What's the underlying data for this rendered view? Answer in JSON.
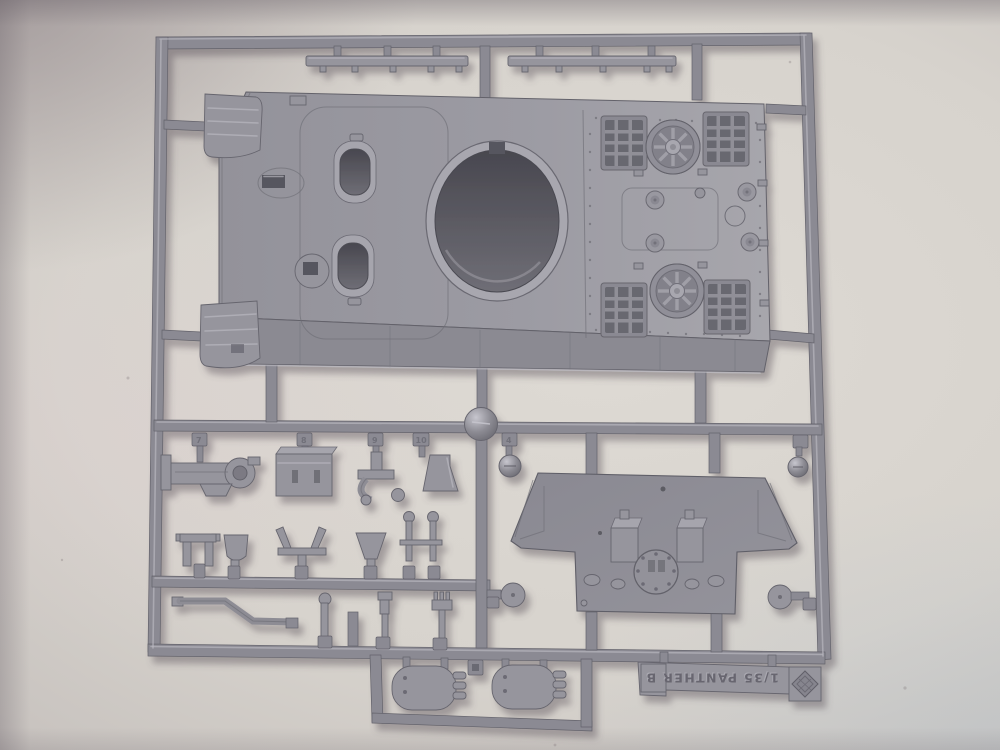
{
  "colors": {
    "background": "#d6d2cc",
    "background_shadow_corner": "#9b9496",
    "background_cool_corner": "#cbd0d3",
    "plastic": "#8e8d95",
    "plastic_light": "#a6a5ad",
    "plastic_highlight": "#c2c1c9",
    "plastic_dark": "#64636b",
    "hole_shadow": "#55545c"
  },
  "sprue": {
    "brand_tag": {
      "text": "1/35 PANTHER B",
      "orientation": "upside-down"
    },
    "part_number_tabs": [
      "7",
      "8",
      "9",
      "10",
      "4"
    ]
  }
}
